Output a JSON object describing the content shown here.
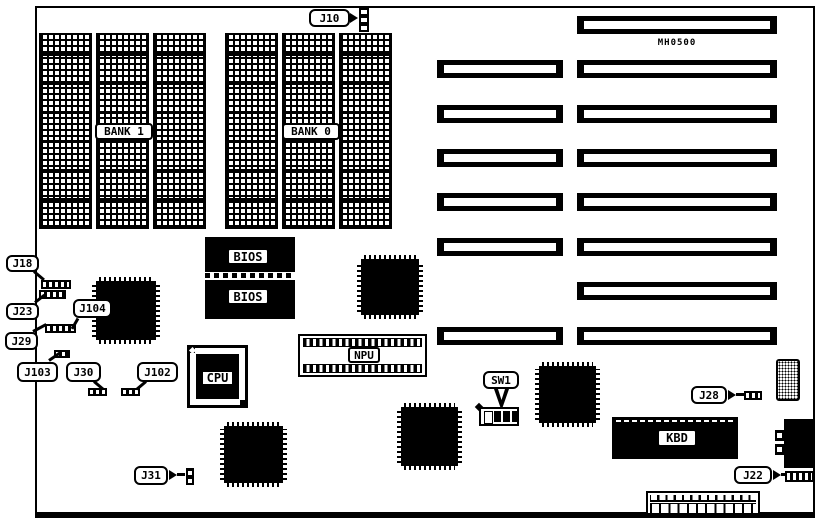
{
  "colors": {
    "ink": "#000000",
    "paper": "#ffffff"
  },
  "board": {
    "model": "MH0500"
  },
  "banks": {
    "bank1": "BANK 1",
    "bank0": "BANK 0"
  },
  "chips": {
    "bios_top": "BIOS",
    "bios_bottom": "BIOS",
    "cpu": "CPU",
    "npu": "NPU",
    "kbd": "KBD"
  },
  "callouts": {
    "j10": "J10",
    "j18": "J18",
    "j23": "J23",
    "j29": "J29",
    "j103": "J103",
    "j104": "J104",
    "j30": "J30",
    "j102": "J102",
    "j31": "J31",
    "sw1": "SW1",
    "j28": "J28",
    "j22": "J22"
  }
}
